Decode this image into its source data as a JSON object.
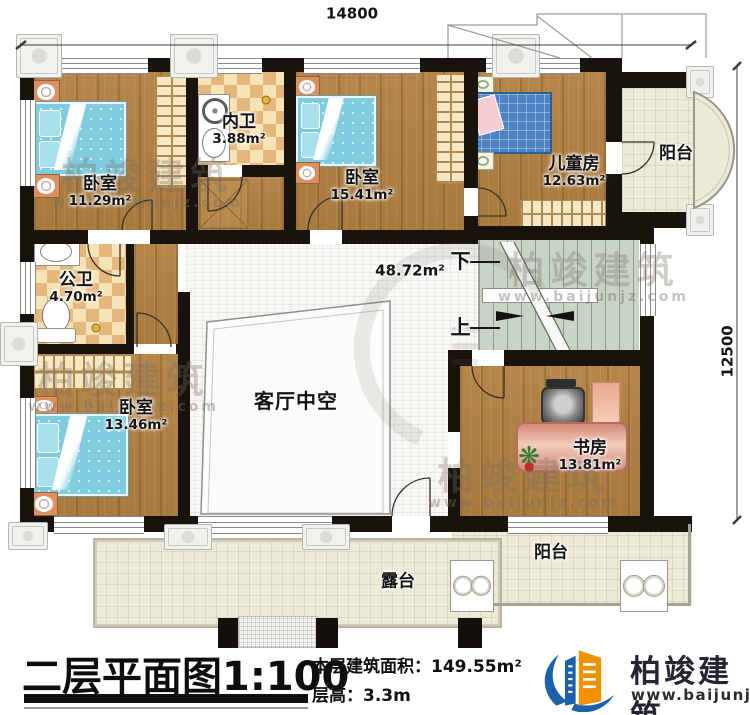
{
  "plan": {
    "dim_top": "14800",
    "dim_right": "12500",
    "rooms": {
      "bedroom1": {
        "name": "卧室",
        "area": "11.29m²"
      },
      "inner_bath": {
        "name": "内卫",
        "area": "3.88m²"
      },
      "bedroom2": {
        "name": "卧室",
        "area": "15.41m²"
      },
      "kids_room": {
        "name": "儿童房",
        "area": "12.63m²"
      },
      "balcony_right": {
        "name": "阳台"
      },
      "public_bath": {
        "name": "公卫",
        "area": "4.70m²"
      },
      "bedroom3": {
        "name": "卧室",
        "area": "13.46m²"
      },
      "hall": {
        "area": "48.72m²"
      },
      "living_void": {
        "name": "客厅中空"
      },
      "study": {
        "name": "书房",
        "area": "13.81m²"
      },
      "balcony_bottom": {
        "name": "阳台"
      },
      "terrace": {
        "name": "露台"
      }
    },
    "stairs": {
      "down": "下",
      "up": "上"
    }
  },
  "title_block": {
    "title": "二层平面图1:100",
    "floor_area": "本层建筑面积：149.55m²",
    "floor_height": "层高：3.3m"
  },
  "brand": {
    "name": "柏竣建筑",
    "url": "www.baijunjz.com"
  }
}
